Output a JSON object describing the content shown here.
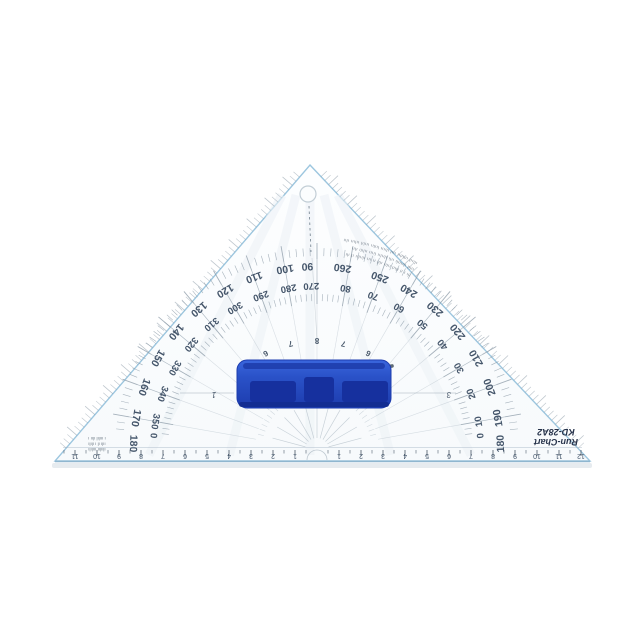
{
  "background": "#ffffff",
  "colors": {
    "edge": "#9cc6df",
    "edge_bottom": "#8fb6cf",
    "body_fill": "#fcfdfe",
    "tick": "#8a99a6",
    "ray": "#9aa8b4",
    "number": "#45566b",
    "handle_blue": "#2a52c8",
    "handle_dark": "#16309e",
    "handle_light": "#4a76e8",
    "handle_arc_gray": "#5f6b76",
    "shadow": "#e6ebef"
  },
  "brand": {
    "line1": "Run-Chart",
    "line2": "KD-28A2"
  },
  "geometry": {
    "apex": [
      310,
      165
    ],
    "corner_left": [
      55,
      461
    ],
    "corner_right": [
      590,
      461
    ],
    "center": [
      317,
      450
    ],
    "r_outer_label": 187,
    "r_inner_label": 167,
    "hole": [
      308,
      194,
      8
    ]
  },
  "protractor": {
    "outer_labels": [
      {
        "a": 178,
        "t": "180"
      },
      {
        "a": 170,
        "t": "170"
      },
      {
        "a": 160,
        "t": "160"
      },
      {
        "a": 150,
        "t": "150"
      },
      {
        "a": 140,
        "t": "140"
      },
      {
        "a": 130,
        "t": "130"
      },
      {
        "a": 120,
        "t": "120"
      },
      {
        "a": 110,
        "t": "110"
      },
      {
        "a": 100,
        "t": "100"
      },
      {
        "a": 93,
        "t": "90"
      },
      {
        "a": 82,
        "t": "260"
      },
      {
        "a": 70,
        "t": "250"
      },
      {
        "a": 60,
        "t": "240"
      },
      {
        "a": 50,
        "t": "230"
      },
      {
        "a": 40,
        "t": "220"
      },
      {
        "a": 30,
        "t": "210"
      },
      {
        "a": 20,
        "t": "200"
      },
      {
        "a": 10,
        "t": "190"
      },
      {
        "a": 2,
        "t": "180"
      }
    ],
    "inner_labels": [
      {
        "a": 175,
        "t": "0"
      },
      {
        "a": 170,
        "t": "350"
      },
      {
        "a": 160,
        "t": "340"
      },
      {
        "a": 150,
        "t": "330"
      },
      {
        "a": 140,
        "t": "320"
      },
      {
        "a": 130,
        "t": "310"
      },
      {
        "a": 120,
        "t": "300"
      },
      {
        "a": 110,
        "t": "290"
      },
      {
        "a": 100,
        "t": "280"
      },
      {
        "a": 92,
        "t": "270"
      },
      {
        "a": 80,
        "t": "80"
      },
      {
        "a": 70,
        "t": "70"
      },
      {
        "a": 60,
        "t": "60"
      },
      {
        "a": 50,
        "t": "50"
      },
      {
        "a": 40,
        "t": "40"
      },
      {
        "a": 30,
        "t": "30"
      },
      {
        "a": 20,
        "t": "20"
      },
      {
        "a": 10,
        "t": "10"
      },
      {
        "a": 5,
        "t": "0"
      }
    ],
    "chord_labels": [
      {
        "a": 118,
        "t": "6"
      },
      {
        "a": 104,
        "t": "7"
      },
      {
        "a": 90,
        "t": "8"
      },
      {
        "a": 76,
        "t": "7"
      },
      {
        "a": 62,
        "t": "6"
      }
    ],
    "misc_labels": [
      {
        "x": 214,
        "y": 392,
        "t": "1"
      },
      {
        "x": 449,
        "y": 392,
        "t": "3"
      }
    ],
    "illegible_arc_lines": [
      "ılıııl ıılıılıı ıııl ılıııı lıılıı ııılıl ıılııı ılıı",
      "ıılıl ılıııılı ıılı ılıılıı lıııı ıılılı ılıı",
      "ılı ı ıl ılııl ıılıı ılıl ıı ııı ılıılıı ıl ılı"
    ]
  },
  "ruler": {
    "units_per_side": 12,
    "numbers_left": [
      "1",
      "2",
      "3",
      "4",
      "5",
      "6",
      "7",
      "8",
      "9",
      "10",
      "11",
      "12"
    ],
    "numbers_right": [
      "1",
      "2",
      "3",
      "4",
      "5",
      "6",
      "7",
      "8",
      "9",
      "10",
      "11",
      "12"
    ]
  },
  "footnote_lines": [
    "ılıılıı ııılılı",
    "ıılı ıl ı ılılı",
    "ı ııılıl ılıı ı"
  ]
}
